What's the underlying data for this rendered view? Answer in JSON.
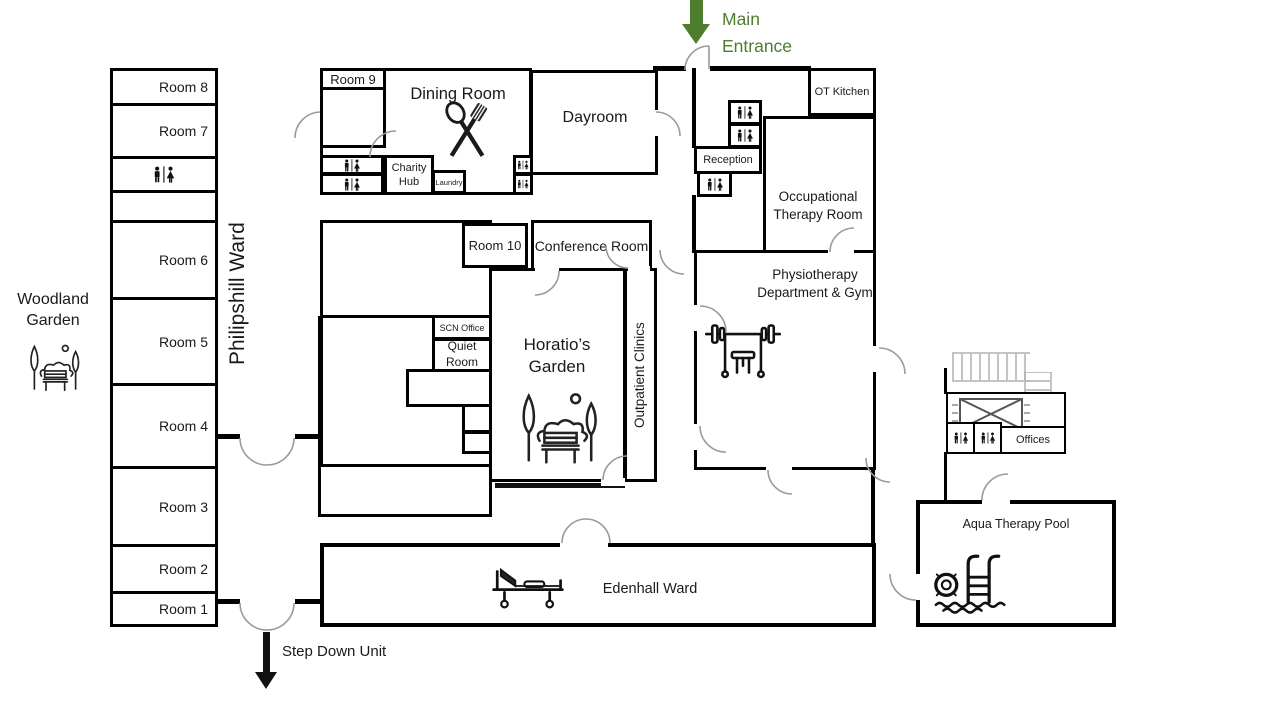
{
  "colors": {
    "entrance_green": "#4e7d2e",
    "wall_black": "#000000",
    "door_gray": "#9a9a9a",
    "stairs_gray": "#b5b5b5"
  },
  "entrance": {
    "label": "Main Entrance"
  },
  "step_down": {
    "label": "Step Down Unit"
  },
  "woodland": {
    "label": "Woodland Garden"
  },
  "philipshill": {
    "name": "Philipshill Ward",
    "rooms": [
      "Room 8",
      "Room 7",
      "Room 6",
      "Room 5",
      "Room 4",
      "Room 3",
      "Room 2",
      "Room 1"
    ]
  },
  "labels": {
    "room9": "Room 9",
    "room10": "Room 10",
    "dining_room": "Dining Room",
    "dayroom": "Dayroom",
    "charity_hub": "Charity Hub",
    "laundry": "Laundry",
    "ot_kitchen": "OT Kitchen",
    "reception": "Reception",
    "occupational_therapy_room": "Occupational Therapy Room",
    "physiotherapy": "Physiotherapy Department & Gym",
    "conference_room": "Conference Room",
    "scn_office": "SCN Office",
    "quiet_room": "Quiet Room",
    "horatios_garden": "Horatio’s Garden",
    "outpatient_clinics": "Outpatient Clinics",
    "offices": "Offices",
    "aqua_therapy_pool": "Aqua Therapy Pool",
    "edenhall_ward": "Edenhall Ward"
  },
  "icons": [
    "wc-icon",
    "dining-icon",
    "garden-icon",
    "gym-icon",
    "bed-icon",
    "pool-icon",
    "stairs-icon",
    "lift-icon",
    "down-arrow-icon"
  ]
}
